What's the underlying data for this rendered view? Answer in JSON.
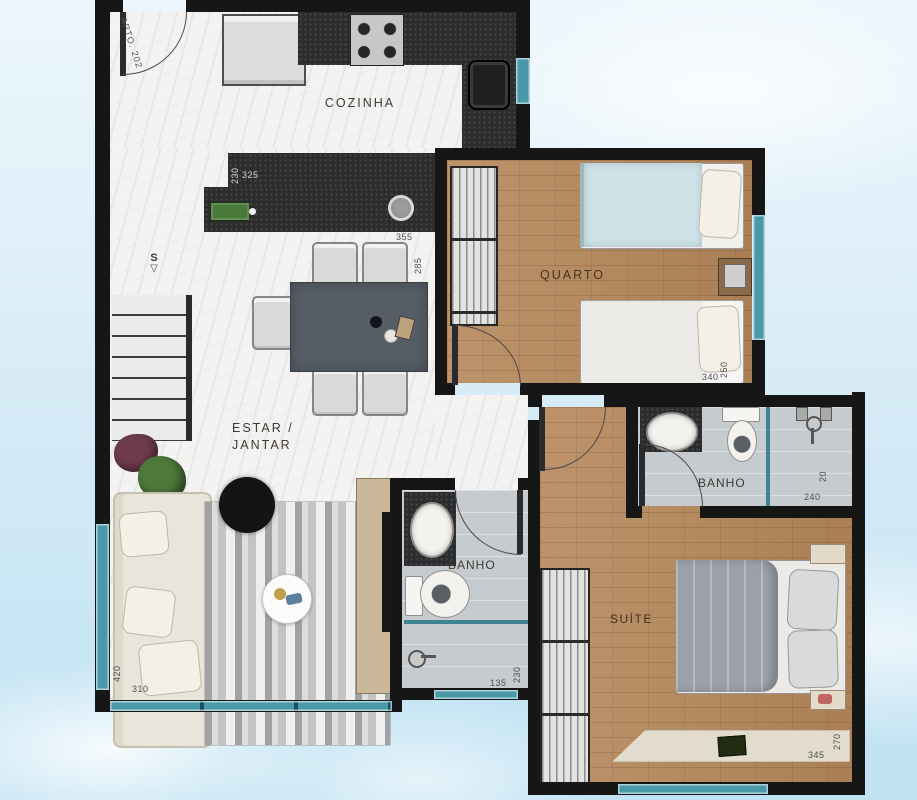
{
  "entrance": {
    "label": "APTO. 202"
  },
  "rooms": {
    "kitchen": {
      "label": "COZINHA"
    },
    "bedroom": {
      "label": "QUARTO"
    },
    "living": {
      "label": "ESTAR /\nJANTAR"
    },
    "bath_social": {
      "label": "BANHO"
    },
    "bath_suite": {
      "label": "BANHO"
    },
    "suite": {
      "label": "SUÍTE"
    }
  },
  "stairs": {
    "label": "S",
    "arrow": "▽"
  },
  "dims": {
    "island_depth": "230",
    "island_width": "325",
    "counter_width": "355",
    "counter_depth": "285",
    "bedroom_width": "340",
    "bedroom_depth": "250",
    "living_width": "310",
    "living_depth": "420",
    "bath_social_width": "135",
    "bath_social_depth": "230",
    "bath_suite_width": "240",
    "bath_suite_depth": "20",
    "suite_width": "345",
    "suite_depth": "270"
  },
  "colors": {
    "wall": "#161616",
    "window_teal": "#4b98a8",
    "wood_floor": "#b5875a",
    "tile_floor": "#c6cbcf",
    "marble_floor": "#f4f3f1",
    "counter_granite": "#2c2c2e",
    "sky": "#bfe2f3"
  }
}
